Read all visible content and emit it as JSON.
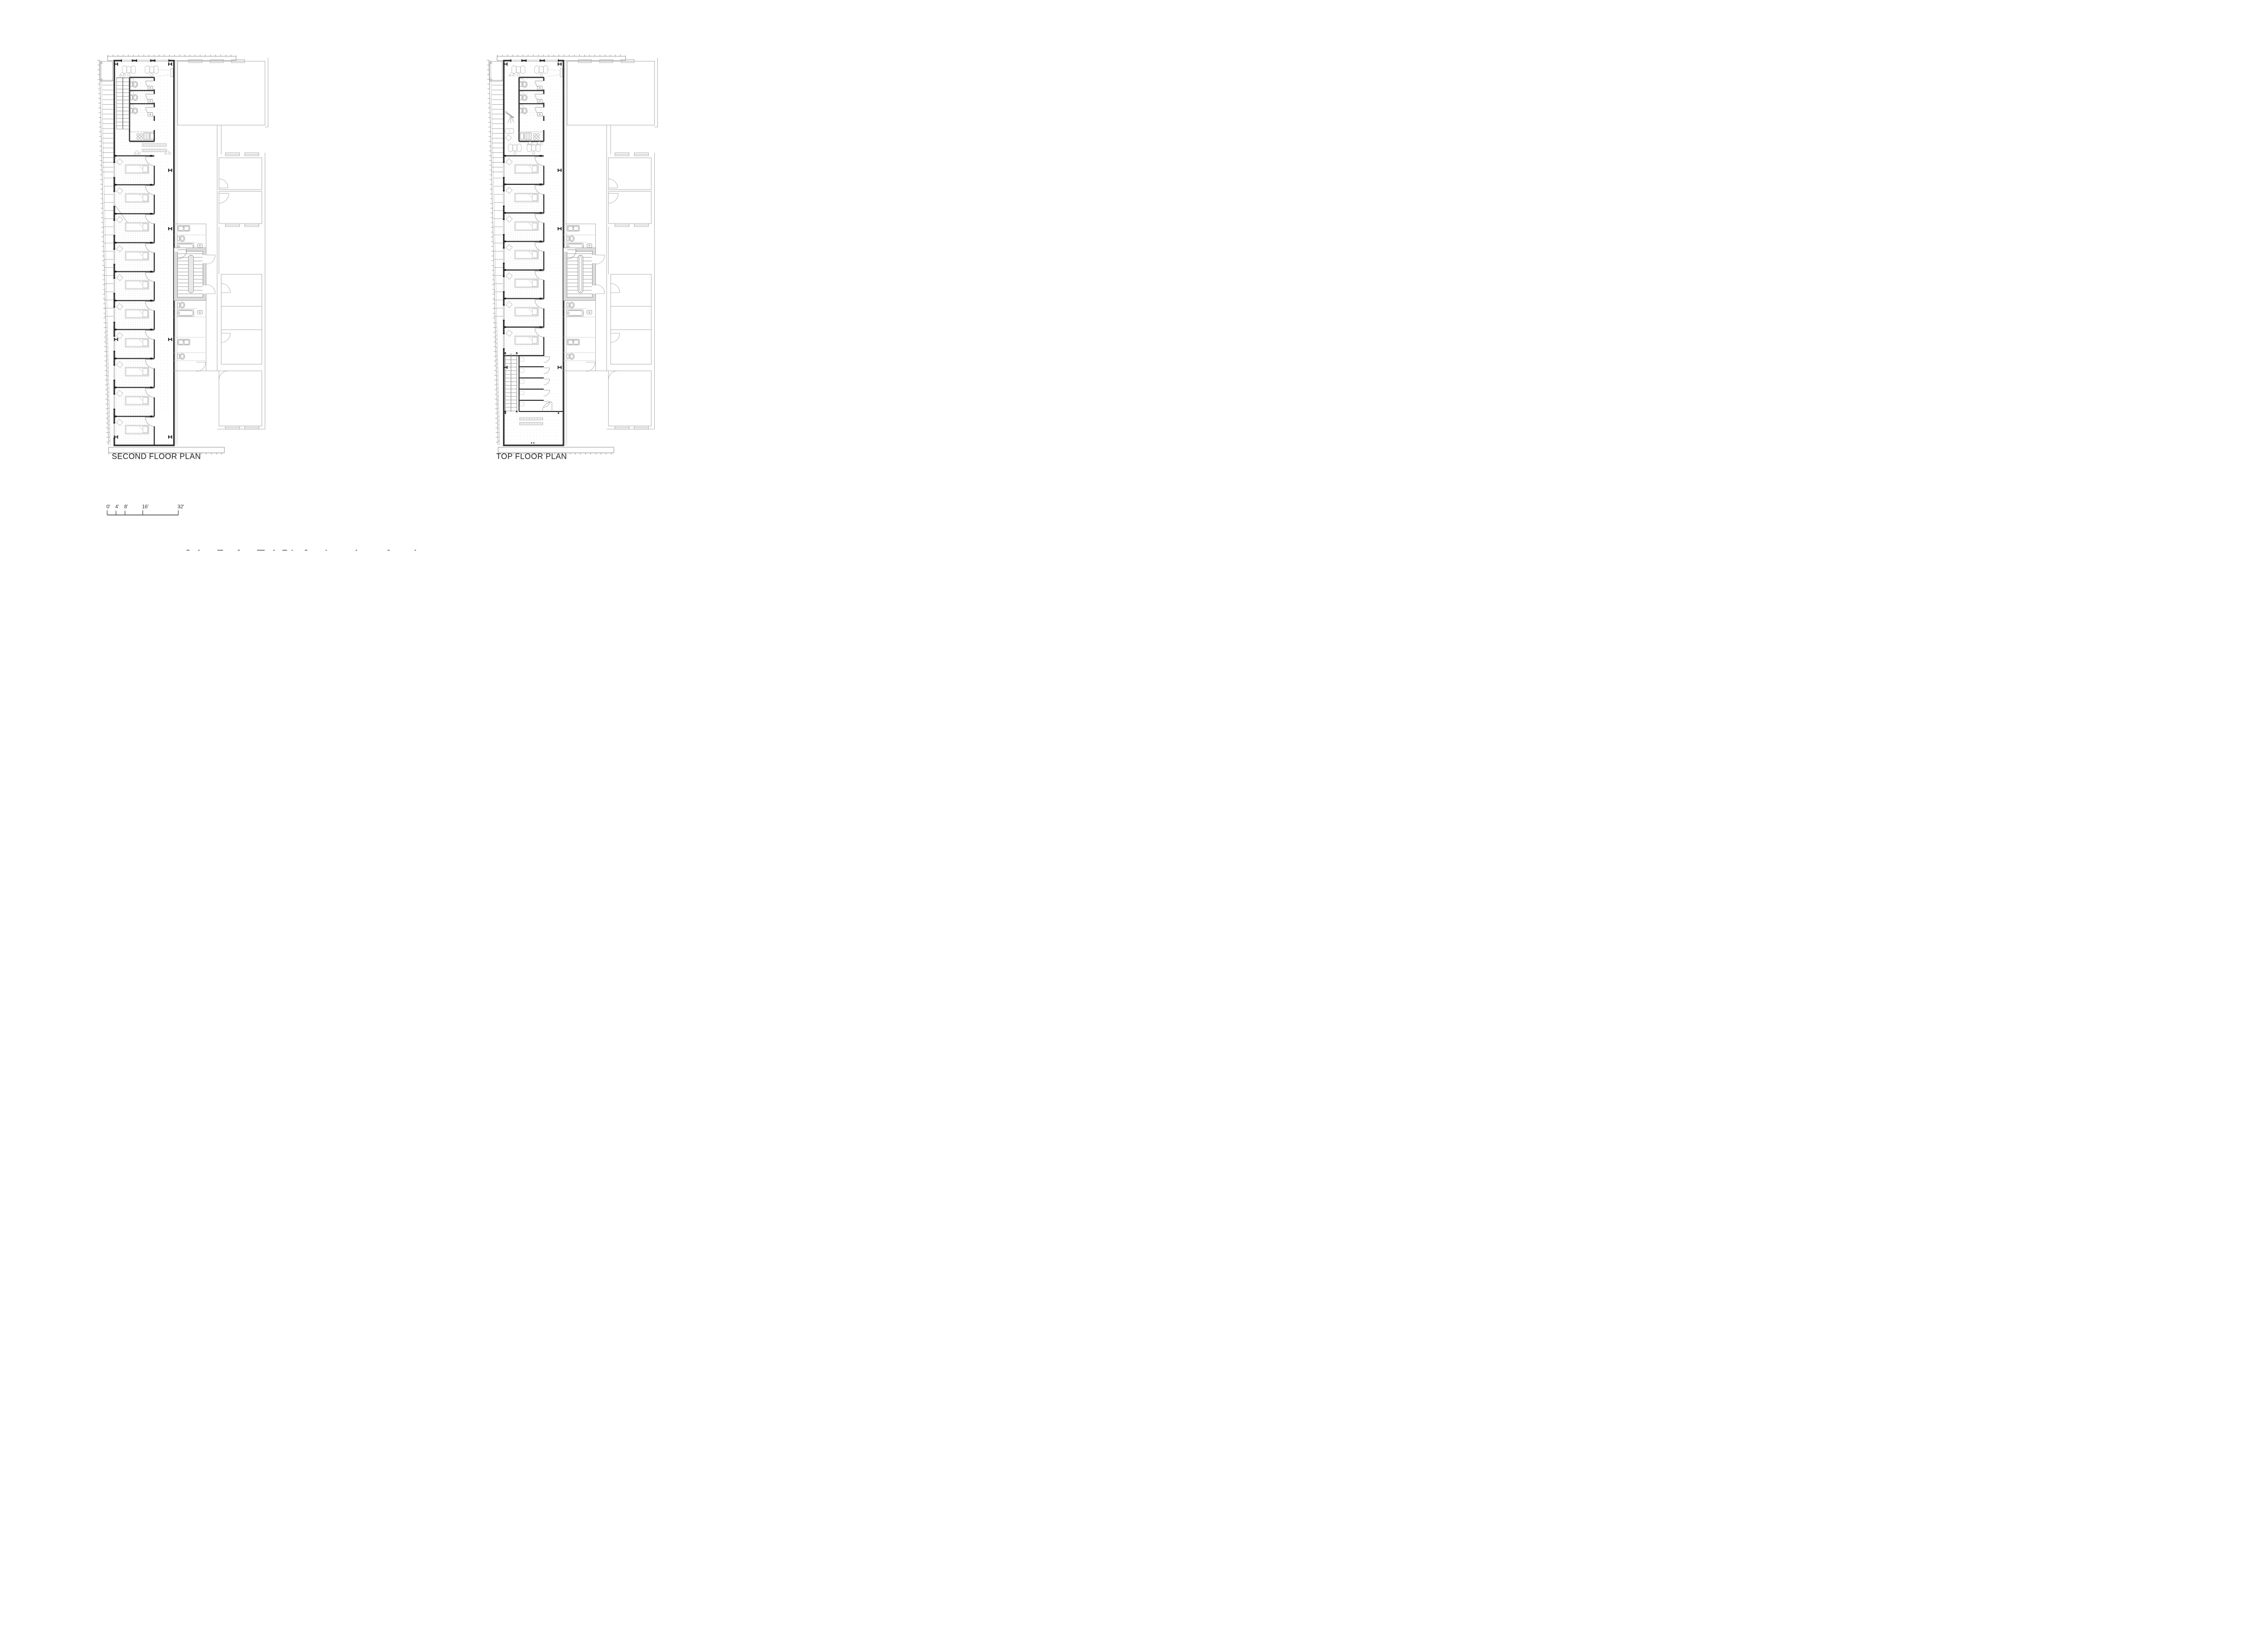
{
  "document": {
    "kind": "architectural floor plan sheet",
    "background": "#ffffff"
  },
  "plans": [
    {
      "id": "second-floor-plan",
      "title": "SECOND FLOOR PLAN"
    },
    {
      "id": "top-floor-plan",
      "title": "TOP FLOOR PLAN"
    }
  ],
  "scale_bar": {
    "unit": "feet",
    "ticks": [
      "0'",
      "4'",
      "8'",
      "16'",
      "32'"
    ]
  },
  "colors": {
    "wall_dark": "#2f2f2f",
    "line_medium": "#8f8f8f",
    "line_light": "#b3b3b3",
    "furniture_light": "#c2c2c2",
    "poche_gray": "#dcdcdc",
    "floor_dots": "#cdcdcd",
    "text": "#1d1d1d"
  }
}
